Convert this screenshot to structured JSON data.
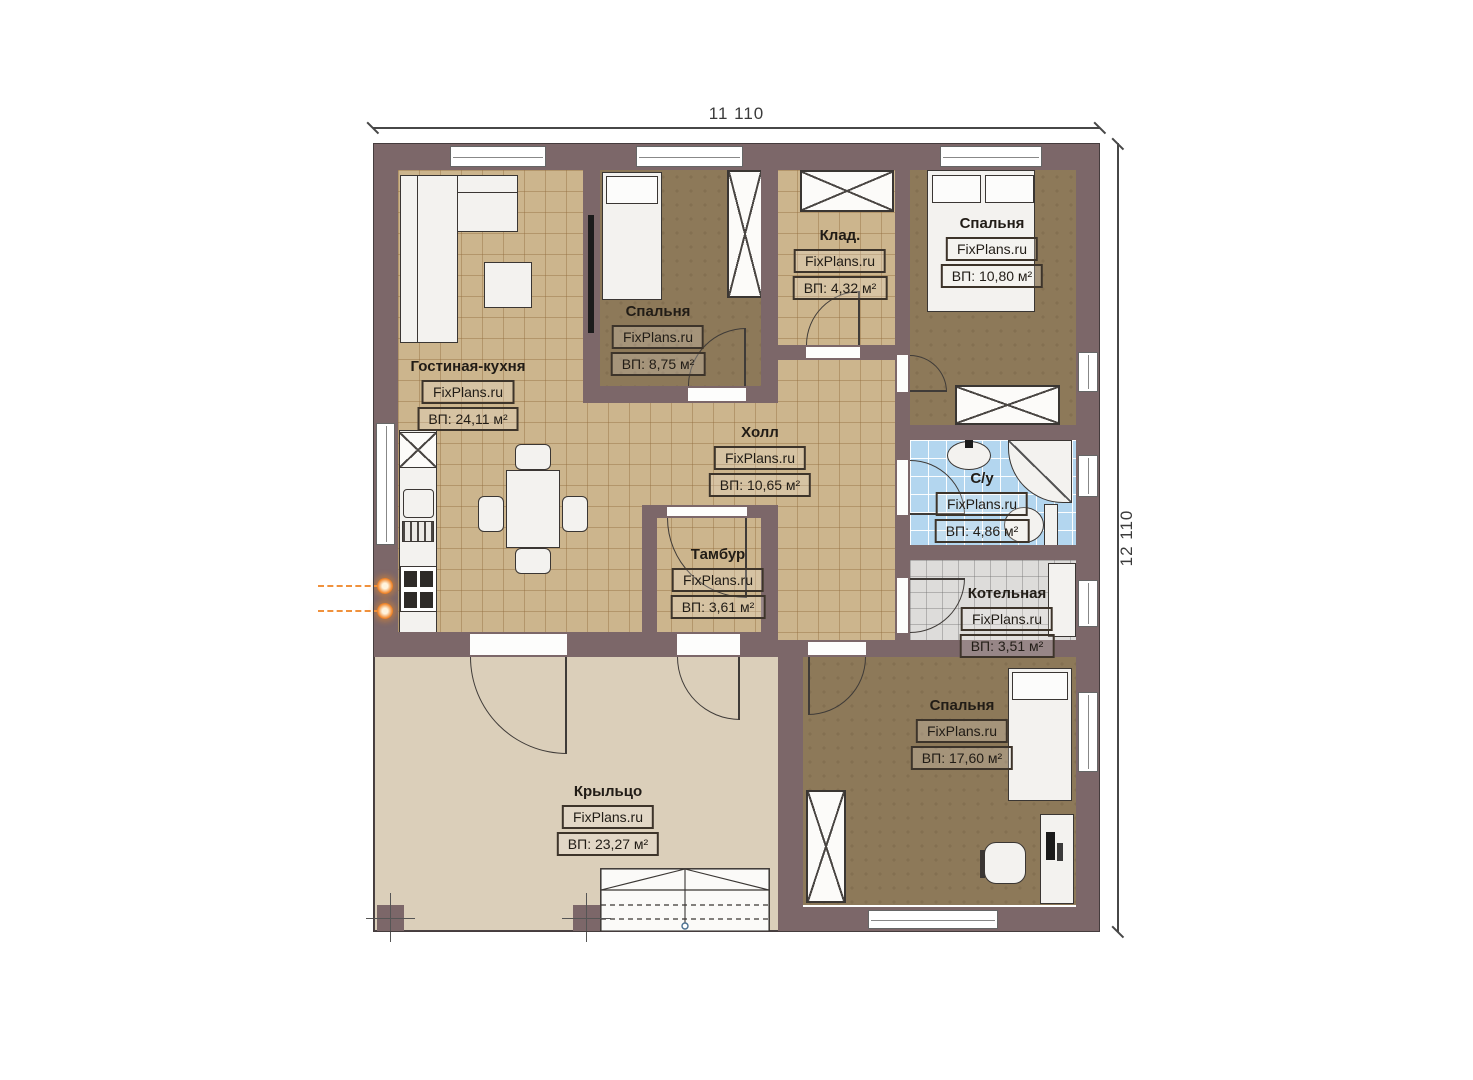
{
  "plan_title": "План одноэтажного дома",
  "brand": {
    "watermark": "FixPlans.ru"
  },
  "dimensions": {
    "width_label": "11 110",
    "height_label": "12 110"
  },
  "rooms": [
    {
      "id": "living-kitchen",
      "name": "Гостиная-кухня",
      "watermark": "FixPlans.ru",
      "area": "ВП: 24,11 м²"
    },
    {
      "id": "bedroom-1",
      "name": "Спальня",
      "watermark": "FixPlans.ru",
      "area": "ВП: 8,75 м²"
    },
    {
      "id": "storage",
      "name": "Клад.",
      "watermark": "FixPlans.ru",
      "area": "ВП: 4,32 м²"
    },
    {
      "id": "bedroom-2",
      "name": "Спальня",
      "watermark": "FixPlans.ru",
      "area": "ВП: 10,80 м²"
    },
    {
      "id": "hall",
      "name": "Холл",
      "watermark": "FixPlans.ru",
      "area": "ВП: 10,65 м²"
    },
    {
      "id": "bathroom",
      "name": "С/у",
      "watermark": "FixPlans.ru",
      "area": "ВП: 4,86 м²"
    },
    {
      "id": "vestibule",
      "name": "Тамбур",
      "watermark": "FixPlans.ru",
      "area": "ВП: 3,61 м²"
    },
    {
      "id": "boiler-room",
      "name": "Котельная",
      "watermark": "FixPlans.ru",
      "area": "ВП: 3,51 м²"
    },
    {
      "id": "bedroom-3",
      "name": "Спальня",
      "watermark": "FixPlans.ru",
      "area": "ВП: 17,60 м²"
    },
    {
      "id": "porch",
      "name": "Крыльцо",
      "watermark": "FixPlans.ru",
      "area": "ВП: 23,27 м²"
    }
  ],
  "colors": {
    "wall": "#7c6769",
    "tile_beige": "#ccb58d",
    "floor_dark": "#8d7959",
    "tile_blue": "#b3d6ef",
    "tile_gray": "#dddcda",
    "porch": "#dbcfba",
    "accent_orange": "#f08428"
  }
}
